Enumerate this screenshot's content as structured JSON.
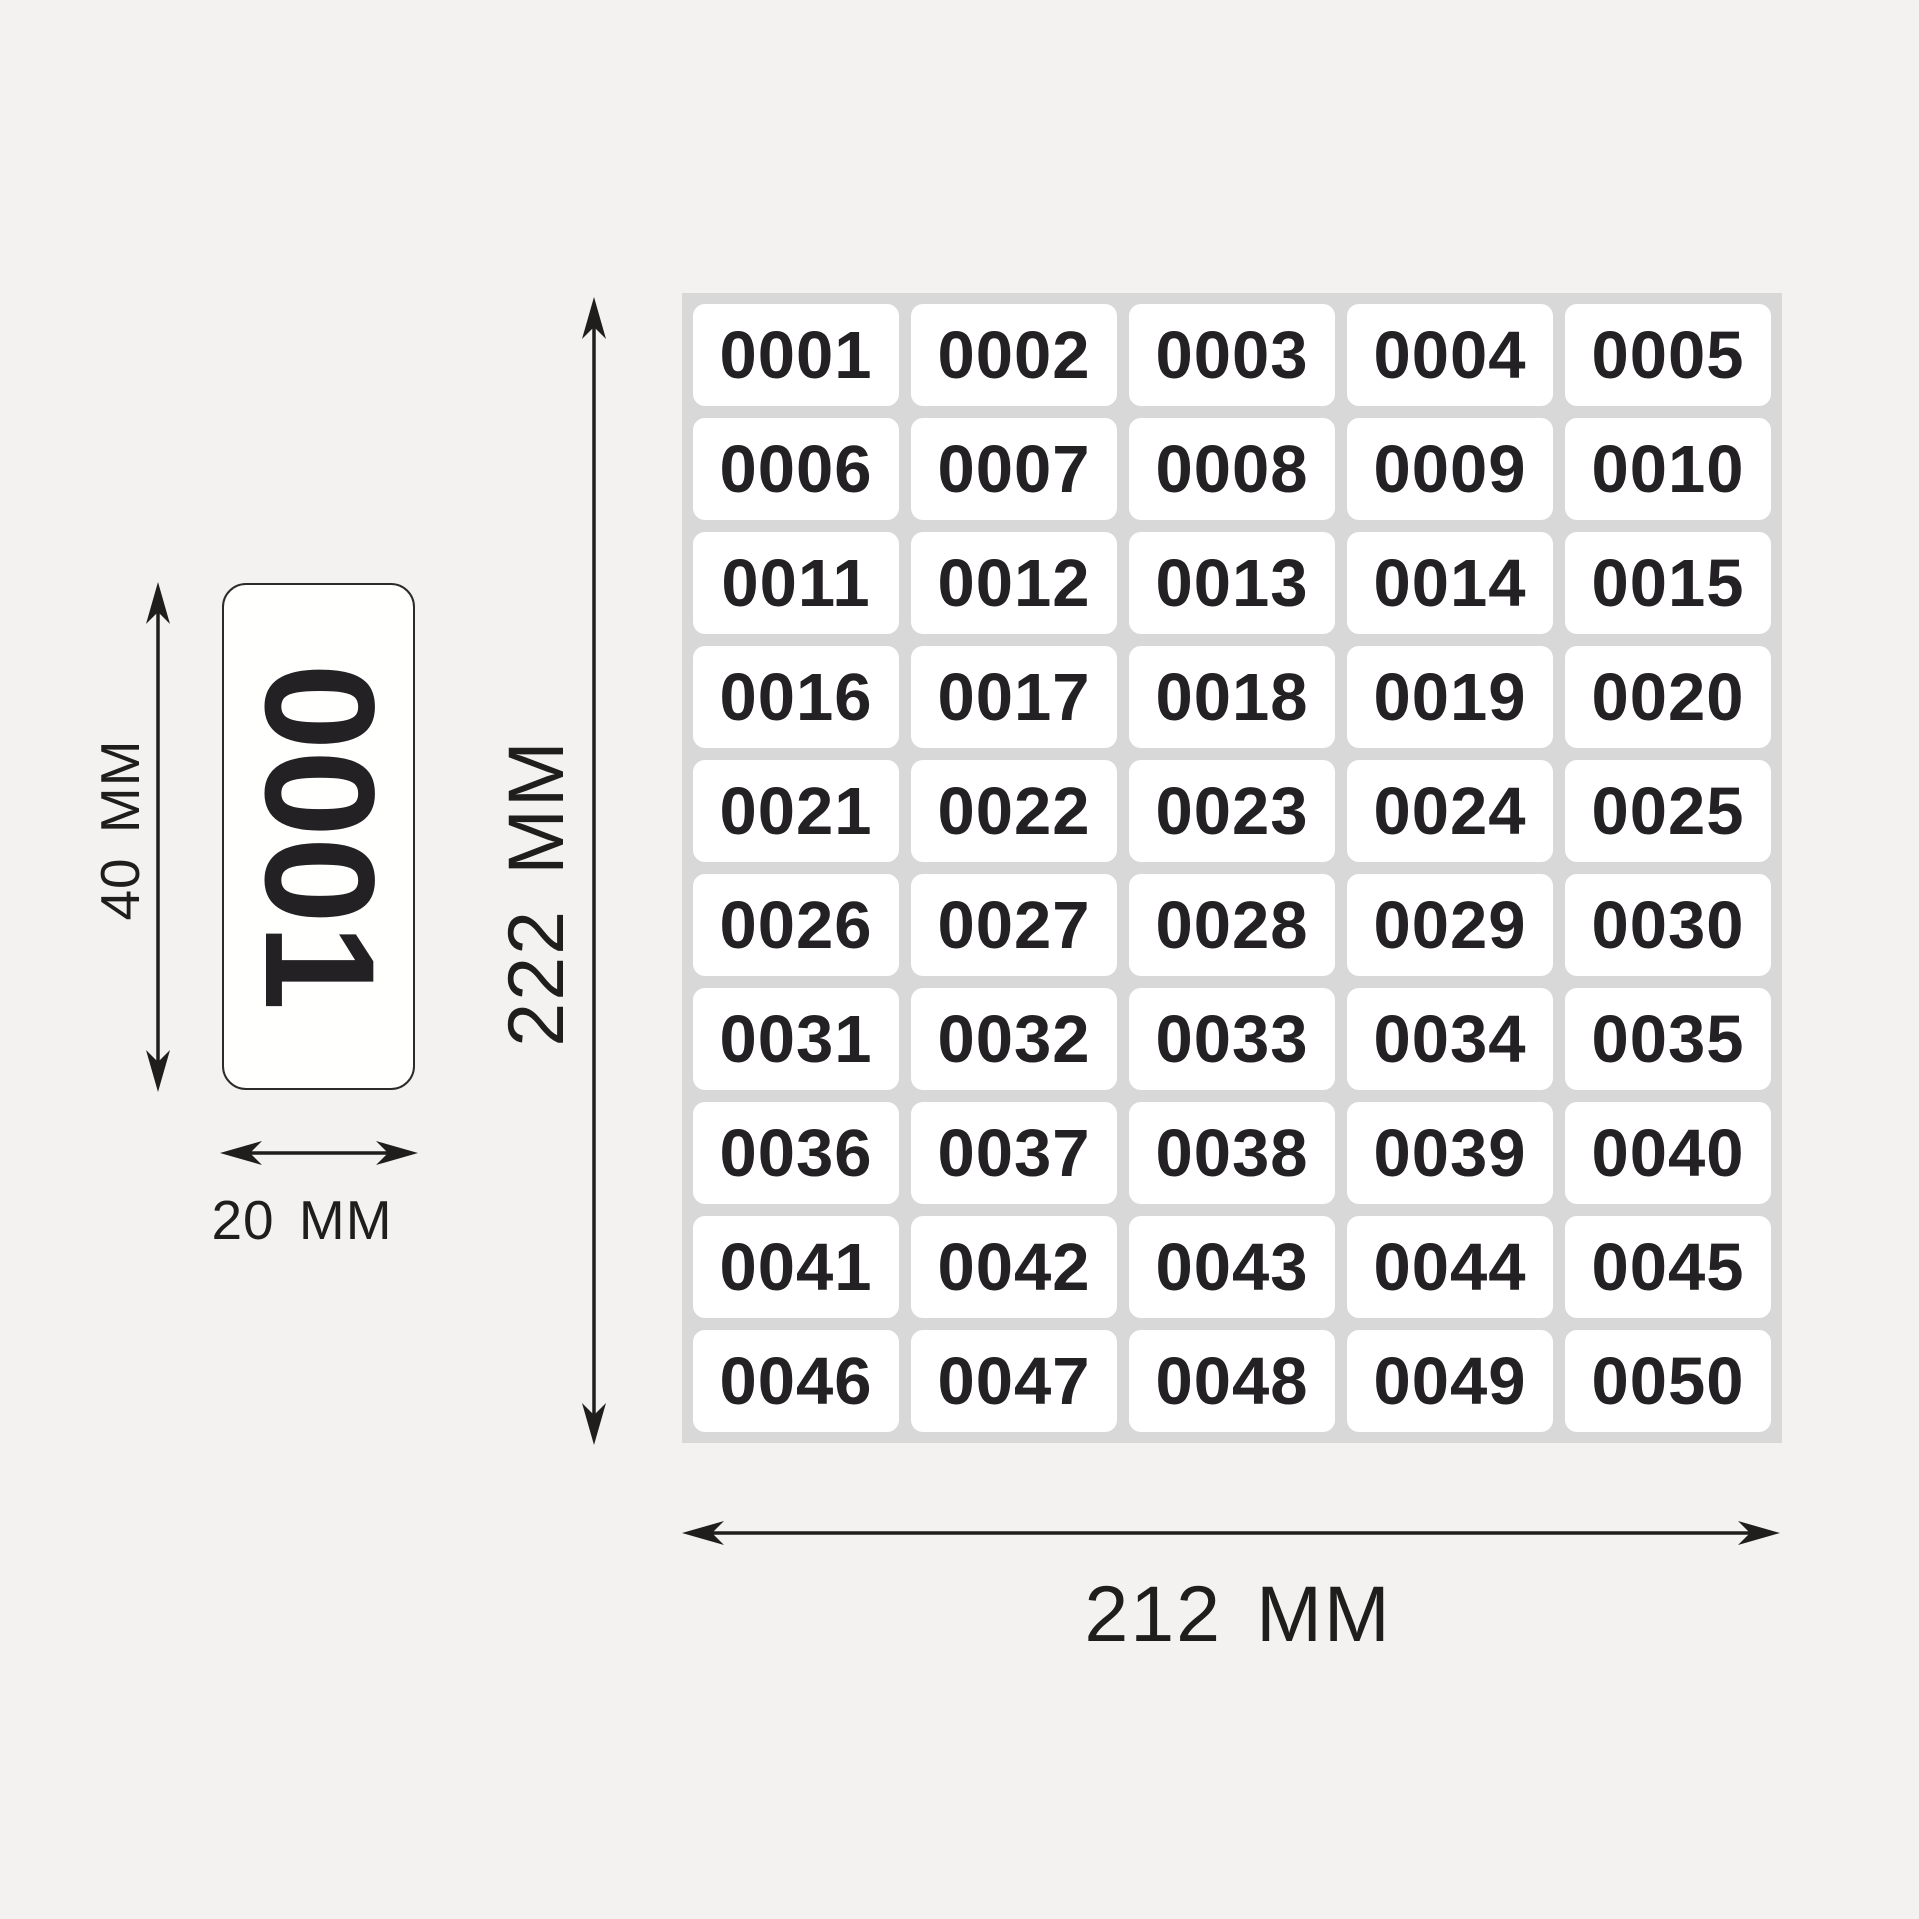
{
  "page": {
    "background_color": "#f3f2f0",
    "ink_color": "#1f1e1c",
    "description": "Numbered sticker sheet dimension diagram"
  },
  "sheet": {
    "background_color": "#d8d8d8",
    "cell_background_color": "#ffffff",
    "number_color": "#242124",
    "rows": 10,
    "columns": 5,
    "cells": [
      "0001",
      "0002",
      "0003",
      "0004",
      "0005",
      "0006",
      "0007",
      "0008",
      "0009",
      "0010",
      "0011",
      "0012",
      "0013",
      "0014",
      "0015",
      "0016",
      "0017",
      "0018",
      "0019",
      "0020",
      "0021",
      "0022",
      "0023",
      "0024",
      "0025",
      "0026",
      "0027",
      "0028",
      "0029",
      "0030",
      "0031",
      "0032",
      "0033",
      "0034",
      "0035",
      "0036",
      "0037",
      "0038",
      "0039",
      "0040",
      "0041",
      "0042",
      "0043",
      "0044",
      "0045",
      "0046",
      "0047",
      "0048",
      "0049",
      "0050"
    ]
  },
  "sample_label": {
    "text": "0001",
    "rotation_deg": 90,
    "border_color": "#2c2b28",
    "background_color": "#fffffe"
  },
  "dimensions": {
    "label_height": {
      "value": "40",
      "unit": "MM",
      "label": "40 MM"
    },
    "label_width": {
      "value": "20",
      "unit": "MM",
      "label": "20 MM"
    },
    "sheet_height": {
      "value": "222",
      "unit": "MM",
      "label": "222 MM"
    },
    "sheet_width": {
      "value": "212",
      "unit": "MM",
      "label": "212 MM"
    }
  }
}
